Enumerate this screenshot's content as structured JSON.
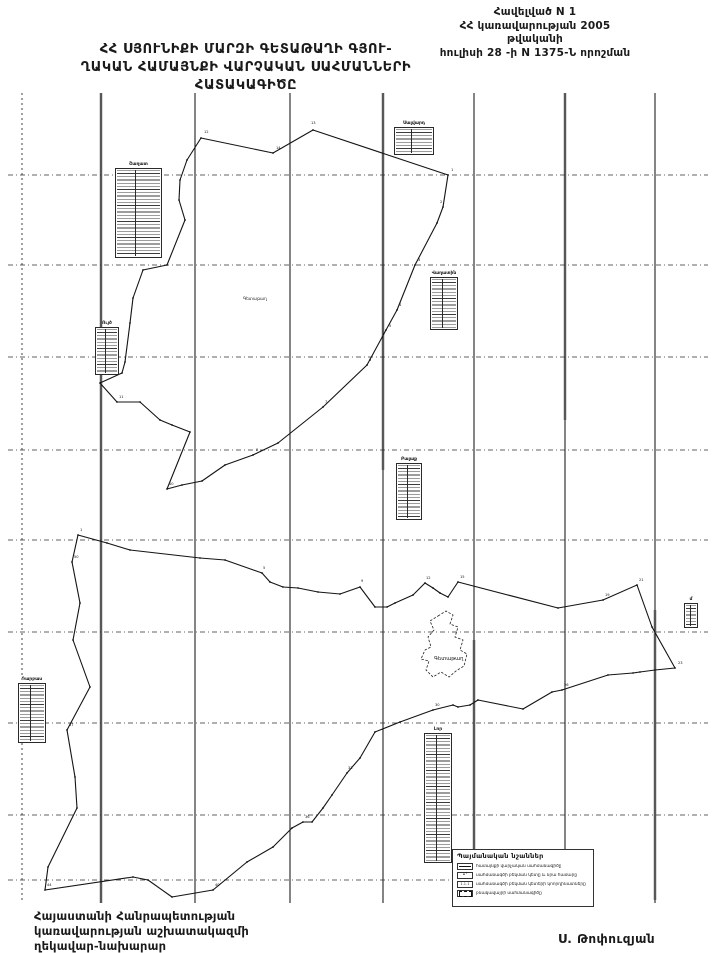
{
  "header": {
    "line1": "Հավելված N 1",
    "line2": "ՀՀ կառավարության  2005 թվականի",
    "line3": "հուլիսի 28 -ի  N 1375-Ն որոշման"
  },
  "title": {
    "line1": "ՀՀ  ՍՅՈՒՆԻՔԻ  ՄԱՐԶԻ  ԳԵՏԱԹԱՂԻ  ԳՅՈՒ-",
    "line2": "ՂԱԿԱՆ ՀԱՄԱՅՆՔԻ ՎԱՐՉԱԿԱՆ ՍԱՀՄԱՆՆԵՐԻ",
    "line3": "ՀԱՏԱԿԱԳԻԾԸ"
  },
  "footer": {
    "left_line1": "Հայաստանի Հանրապետության",
    "left_line2": "կառավարության աշխատակազմի",
    "left_line3": "ղեկավար-նախարար",
    "signature": "Ս. Թոփուզյան"
  },
  "legend": {
    "title": "Պայմանական նշաններ",
    "items": [
      {
        "symbol": "boundary-line",
        "text": "համայնքի վարչական սահմանագիծը"
      },
      {
        "symbol": "turning-point",
        "text": "սահմանագծի բեկման կետը և նրա համարը"
      },
      {
        "symbol": "coordinate-table",
        "text": "սահմանագծի բեկման կետերի կոորդինատները"
      },
      {
        "symbol": "settlement-line",
        "text": "բնակավայրի սահմանագիծը"
      }
    ]
  },
  "colors": {
    "ink": "#1a1a1a",
    "grid_grey": "#a0a0a0",
    "paper": "#ffffff"
  },
  "map": {
    "top": 93,
    "bottom": 903,
    "left": 8,
    "right": 708,
    "vlines": [
      {
        "x": 22,
        "dashed": true
      },
      {
        "x": 101,
        "grey": [
          93,
          903
        ]
      },
      {
        "x": 195
      },
      {
        "x": 290
      },
      {
        "x": 383,
        "grey": [
          93,
          470
        ]
      },
      {
        "x": 474,
        "grey": [
          640,
          900
        ]
      },
      {
        "x": 565,
        "grey": [
          93,
          420
        ]
      },
      {
        "x": 655,
        "grey": [
          610,
          900
        ]
      }
    ],
    "hlines": [
      {
        "y": 175
      },
      {
        "y": 265
      },
      {
        "y": 357
      },
      {
        "y": 450
      },
      {
        "y": 540
      },
      {
        "y": 632
      },
      {
        "y": 723
      },
      {
        "y": 815
      },
      {
        "y": 880,
        "x2": 452
      }
    ],
    "north_polygon": [
      [
        201,
        138
      ],
      [
        273,
        153
      ],
      [
        313,
        130
      ],
      [
        448,
        175
      ],
      [
        443,
        207
      ],
      [
        437,
        223
      ],
      [
        415,
        265
      ],
      [
        397,
        310
      ],
      [
        386,
        330
      ],
      [
        367,
        365
      ],
      [
        323,
        407
      ],
      [
        278,
        443
      ],
      [
        253,
        455
      ],
      [
        225,
        465
      ],
      [
        202,
        481
      ],
      [
        182,
        485
      ],
      [
        167,
        489
      ],
      [
        190,
        432
      ],
      [
        172,
        425
      ],
      [
        160,
        420
      ],
      [
        140,
        402
      ],
      [
        117,
        402
      ],
      [
        100,
        383
      ],
      [
        122,
        373
      ],
      [
        125,
        362
      ],
      [
        130,
        323
      ],
      [
        133,
        298
      ],
      [
        143,
        270
      ],
      [
        167,
        265
      ],
      [
        185,
        220
      ],
      [
        179,
        200
      ],
      [
        180,
        180
      ],
      [
        187,
        160
      ]
    ],
    "south_polygon": [
      [
        78,
        535
      ],
      [
        107,
        543
      ],
      [
        130,
        550
      ],
      [
        200,
        558
      ],
      [
        225,
        560
      ],
      [
        262,
        573
      ],
      [
        270,
        582
      ],
      [
        283,
        587
      ],
      [
        298,
        588
      ],
      [
        318,
        592
      ],
      [
        340,
        594
      ],
      [
        360,
        587
      ],
      [
        375,
        607
      ],
      [
        387,
        607
      ],
      [
        395,
        603
      ],
      [
        413,
        595
      ],
      [
        425,
        583
      ],
      [
        433,
        588
      ],
      [
        440,
        593
      ],
      [
        448,
        597
      ],
      [
        458,
        582
      ],
      [
        558,
        608
      ],
      [
        603,
        600
      ],
      [
        637,
        585
      ],
      [
        652,
        627
      ],
      [
        675,
        668
      ],
      [
        655,
        670
      ],
      [
        640,
        672
      ],
      [
        633,
        673
      ],
      [
        608,
        675
      ],
      [
        562,
        690
      ],
      [
        552,
        692
      ],
      [
        523,
        709
      ],
      [
        478,
        700
      ],
      [
        470,
        705
      ],
      [
        458,
        707
      ],
      [
        453,
        705
      ],
      [
        433,
        710
      ],
      [
        400,
        722
      ],
      [
        375,
        732
      ],
      [
        360,
        758
      ],
      [
        347,
        773
      ],
      [
        332,
        795
      ],
      [
        323,
        808
      ],
      [
        312,
        822
      ],
      [
        303,
        822
      ],
      [
        292,
        828
      ],
      [
        273,
        847
      ],
      [
        247,
        862
      ],
      [
        213,
        890
      ],
      [
        172,
        897
      ],
      [
        148,
        880
      ],
      [
        133,
        877
      ],
      [
        45,
        890
      ],
      [
        48,
        867
      ],
      [
        77,
        808
      ],
      [
        75,
        777
      ],
      [
        67,
        730
      ],
      [
        90,
        687
      ],
      [
        73,
        640
      ],
      [
        80,
        603
      ],
      [
        72,
        562
      ]
    ],
    "village": {
      "label": "Գետաթաղ",
      "label_pos": [
        434,
        660
      ],
      "outline": [
        [
          438,
          616
        ],
        [
          446,
          611
        ],
        [
          453,
          615
        ],
        [
          450,
          624
        ],
        [
          458,
          627
        ],
        [
          455,
          637
        ],
        [
          463,
          640
        ],
        [
          460,
          650
        ],
        [
          467,
          654
        ],
        [
          464,
          666
        ],
        [
          456,
          671
        ],
        [
          449,
          677
        ],
        [
          441,
          672
        ],
        [
          433,
          677
        ],
        [
          426,
          670
        ],
        [
          429,
          661
        ],
        [
          421,
          659
        ],
        [
          425,
          650
        ],
        [
          431,
          647
        ],
        [
          428,
          637
        ],
        [
          434,
          630
        ],
        [
          430,
          621
        ]
      ]
    },
    "area_label": {
      "text": "Գետաթաղ",
      "x": 243,
      "y": 300
    },
    "tables": [
      {
        "label": "Շաղատ",
        "x": 115,
        "y": 168,
        "w": 47,
        "h": 90
      },
      {
        "label": "Ույծ",
        "x": 95,
        "y": 327,
        "w": 24,
        "h": 48
      },
      {
        "label": "Սալվարդ",
        "x": 394,
        "y": 127,
        "w": 40,
        "h": 28
      },
      {
        "label": "Վաղատին",
        "x": 430,
        "y": 277,
        "w": 28,
        "h": 53
      },
      {
        "label": "Բալաք",
        "x": 396,
        "y": 463,
        "w": 26,
        "h": 57
      },
      {
        "label": "Դարբաս",
        "x": 18,
        "y": 683,
        "w": 28,
        "h": 60
      },
      {
        "label": "Լոր",
        "x": 424,
        "y": 733,
        "w": 28,
        "h": 130
      },
      {
        "label": "մ",
        "x": 684,
        "y": 603,
        "w": 14,
        "h": 25
      }
    ],
    "point_labels": [
      {
        "t": "12",
        "x": 204,
        "y": 133
      },
      {
        "t": "13",
        "x": 311,
        "y": 124
      },
      {
        "t": "14",
        "x": 276,
        "y": 149
      },
      {
        "t": "1",
        "x": 451,
        "y": 171
      },
      {
        "t": "2",
        "x": 440,
        "y": 203
      },
      {
        "t": "3",
        "x": 418,
        "y": 261
      },
      {
        "t": "4",
        "x": 399,
        "y": 306
      },
      {
        "t": "5",
        "x": 389,
        "y": 327
      },
      {
        "t": "6",
        "x": 369,
        "y": 361
      },
      {
        "t": "7",
        "x": 325,
        "y": 403
      },
      {
        "t": "8",
        "x": 256,
        "y": 451
      },
      {
        "t": "10",
        "x": 169,
        "y": 485
      },
      {
        "t": "11",
        "x": 119,
        "y": 398
      },
      {
        "t": "1",
        "x": 80,
        "y": 531
      },
      {
        "t": "5",
        "x": 263,
        "y": 569
      },
      {
        "t": "9",
        "x": 361,
        "y": 582
      },
      {
        "t": "12",
        "x": 426,
        "y": 579
      },
      {
        "t": "15",
        "x": 460,
        "y": 578
      },
      {
        "t": "19",
        "x": 605,
        "y": 596
      },
      {
        "t": "21",
        "x": 639,
        "y": 581
      },
      {
        "t": "23",
        "x": 678,
        "y": 664
      },
      {
        "t": "26",
        "x": 564,
        "y": 686
      },
      {
        "t": "30",
        "x": 435,
        "y": 706
      },
      {
        "t": "33",
        "x": 348,
        "y": 769
      },
      {
        "t": "36",
        "x": 305,
        "y": 818
      },
      {
        "t": "40",
        "x": 215,
        "y": 886
      },
      {
        "t": "44",
        "x": 47,
        "y": 886
      },
      {
        "t": "47",
        "x": 69,
        "y": 726
      },
      {
        "t": "50",
        "x": 74,
        "y": 558
      }
    ]
  }
}
